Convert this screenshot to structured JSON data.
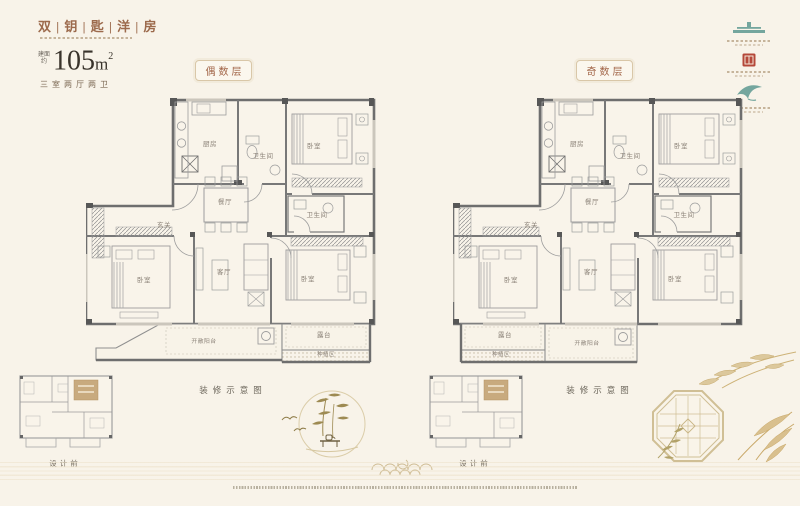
{
  "page": {
    "background": "#f8f3e9"
  },
  "header": {
    "title": "双 | 钥 | 匙 | 洋 | 房",
    "area_prefix": [
      "建面",
      "约"
    ],
    "area_number": "105",
    "area_unit": "m",
    "area_exponent": "2",
    "spec": "三室两厅两卫"
  },
  "floor_tags": {
    "even": "偶数层",
    "odd": "奇数层"
  },
  "plans": {
    "left": {
      "caption": "装修示意图",
      "rooms": {
        "kitchen": "厨房",
        "bath_top": "卫生间",
        "bedroom_top": "卧室",
        "bath_mid": "卫生间",
        "dining": "餐厅",
        "entry": "玄关",
        "bedroom_left": "卧室",
        "living": "客厅",
        "bedroom_right": "卧室",
        "open_balcony": "开敞阳台",
        "terrace": "露台",
        "planting": "种植区"
      }
    },
    "right": {
      "caption": "装修示意图",
      "rooms": {
        "kitchen": "厨房",
        "bath_top": "卫生间",
        "bedroom_top": "卧室",
        "bath_mid": "卫生间",
        "dining": "餐厅",
        "entry": "玄关",
        "bedroom_left": "卧室",
        "living": "客厅",
        "bedroom_right": "卧室",
        "open_balcony": "开敞阳台",
        "terrace": "露台",
        "planting": "种植区"
      }
    }
  },
  "mini_plans": {
    "left": {
      "label": "设计前"
    },
    "right": {
      "label": "设计前"
    }
  },
  "logos": [
    {
      "icon": "pavilion-icon"
    },
    {
      "icon": "seal-icon"
    },
    {
      "icon": "bird-icon"
    }
  ],
  "colors": {
    "accent_brown": "#9c6a4c",
    "seal_red": "#b5483a",
    "logo_teal": "#74a69e",
    "gold": "#cdb37e",
    "wall_gray": "#6e6e6e"
  }
}
